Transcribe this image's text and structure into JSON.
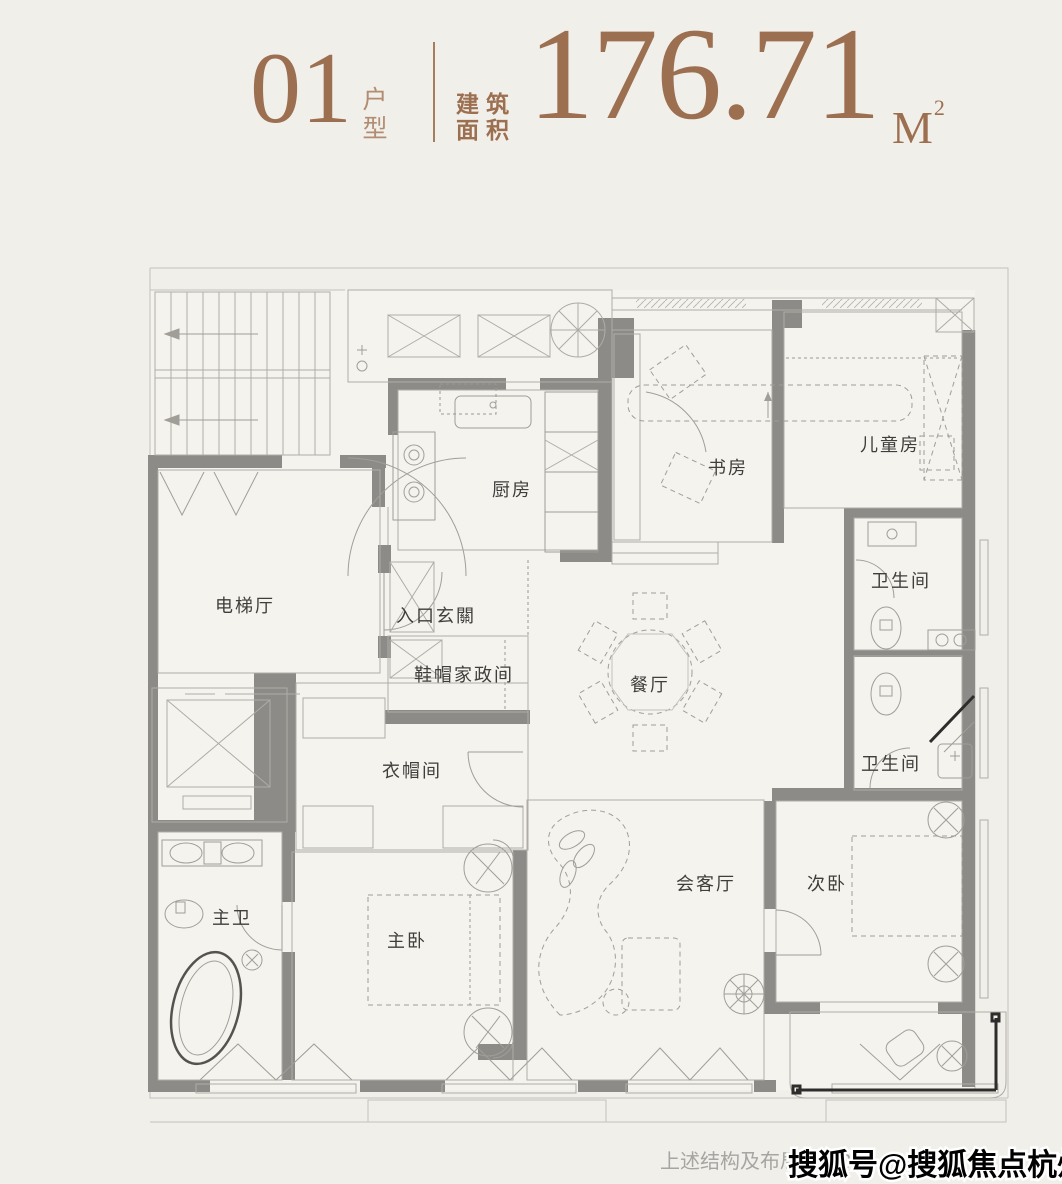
{
  "header": {
    "unit_number": "01",
    "unit_type_label": "户型",
    "area_label_top": "建筑",
    "area_label_bottom": "面积",
    "area_value": "176.71",
    "area_unit": "M",
    "area_unit_sup": "2",
    "accent_color": "#9c6f51"
  },
  "floorplan": {
    "wall_color": "#8d8b87",
    "line_color": "#aeaca5",
    "label_color": "#3f3e3b",
    "rooms": [
      {
        "id": "lift-lobby",
        "name": "电梯厅",
        "x": 245,
        "y": 612
      },
      {
        "id": "kitchen",
        "name": "厨房",
        "x": 512,
        "y": 496
      },
      {
        "id": "entry-foyer",
        "name": "入口玄關",
        "x": 436,
        "y": 622
      },
      {
        "id": "shoe-utility",
        "name": "鞋帽家政间",
        "x": 464,
        "y": 681
      },
      {
        "id": "study",
        "name": "书房",
        "x": 728,
        "y": 474
      },
      {
        "id": "kids-room",
        "name": "儿童房",
        "x": 890,
        "y": 451
      },
      {
        "id": "bathroom-upper",
        "name": "卫生间",
        "x": 901,
        "y": 587
      },
      {
        "id": "dining-room",
        "name": "餐厅",
        "x": 650,
        "y": 691
      },
      {
        "id": "bathroom-lower",
        "name": "卫生间",
        "x": 891,
        "y": 770
      },
      {
        "id": "cloakroom",
        "name": "衣帽间",
        "x": 412,
        "y": 777
      },
      {
        "id": "master-bathroom",
        "name": "主卫",
        "x": 232,
        "y": 924
      },
      {
        "id": "master-bedroom",
        "name": "主卧",
        "x": 407,
        "y": 947
      },
      {
        "id": "living-room",
        "name": "会客厅",
        "x": 706,
        "y": 890
      },
      {
        "id": "second-bedroom",
        "name": "次卧",
        "x": 827,
        "y": 890
      }
    ]
  },
  "footer": {
    "disclaimer": "上述结构及布局仅为3",
    "watermark": "搜狐号@搜狐焦点杭州站"
  }
}
